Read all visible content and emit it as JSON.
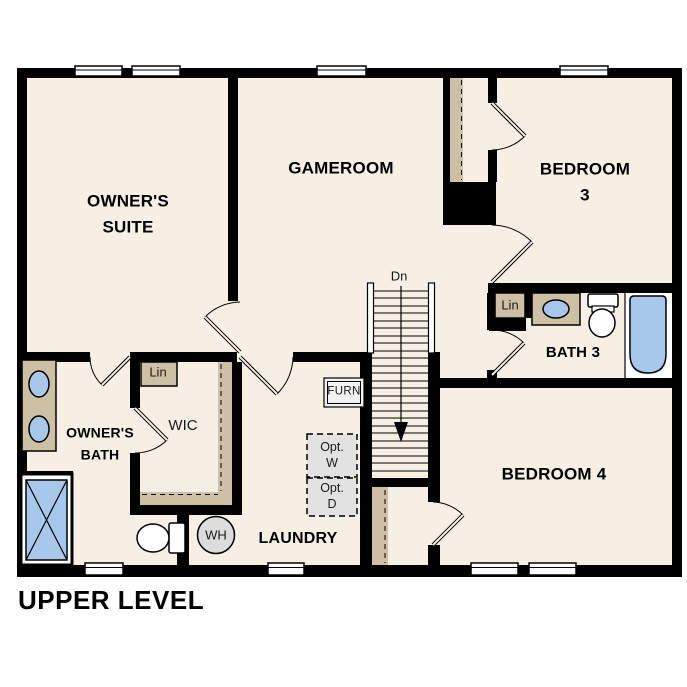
{
  "plan_title": "UPPER LEVEL",
  "rooms": {
    "owners_suite": {
      "label": "OWNER'S\nSUITE"
    },
    "gameroom": {
      "label": "GAMEROOM"
    },
    "bedroom3": {
      "label": "BEDROOM 3"
    },
    "bath3": {
      "label": "BATH 3"
    },
    "bedroom4": {
      "label": "BEDROOM 4"
    },
    "owners_bath": {
      "label": "OWNER'S\nBATH"
    },
    "wic": {
      "label": "WIC"
    },
    "laundry": {
      "label": "LAUNDRY"
    }
  },
  "annotations": {
    "stairs_down": "Dn",
    "wic_linen": "Lin",
    "bath3_linen": "Lin",
    "furnace": "FURN",
    "optional_washer": "Opt.\nW",
    "optional_dryer": "Opt.\nD",
    "water_heater": "WH"
  },
  "colors": {
    "floor": "#f7efe3",
    "wall": "#000000",
    "cabinetry": "#cec0a5",
    "plumbing_blue": "#a7c8eb",
    "optional_fill": "#e2e2e2",
    "water_heater_fill": "#dcdcdc"
  }
}
